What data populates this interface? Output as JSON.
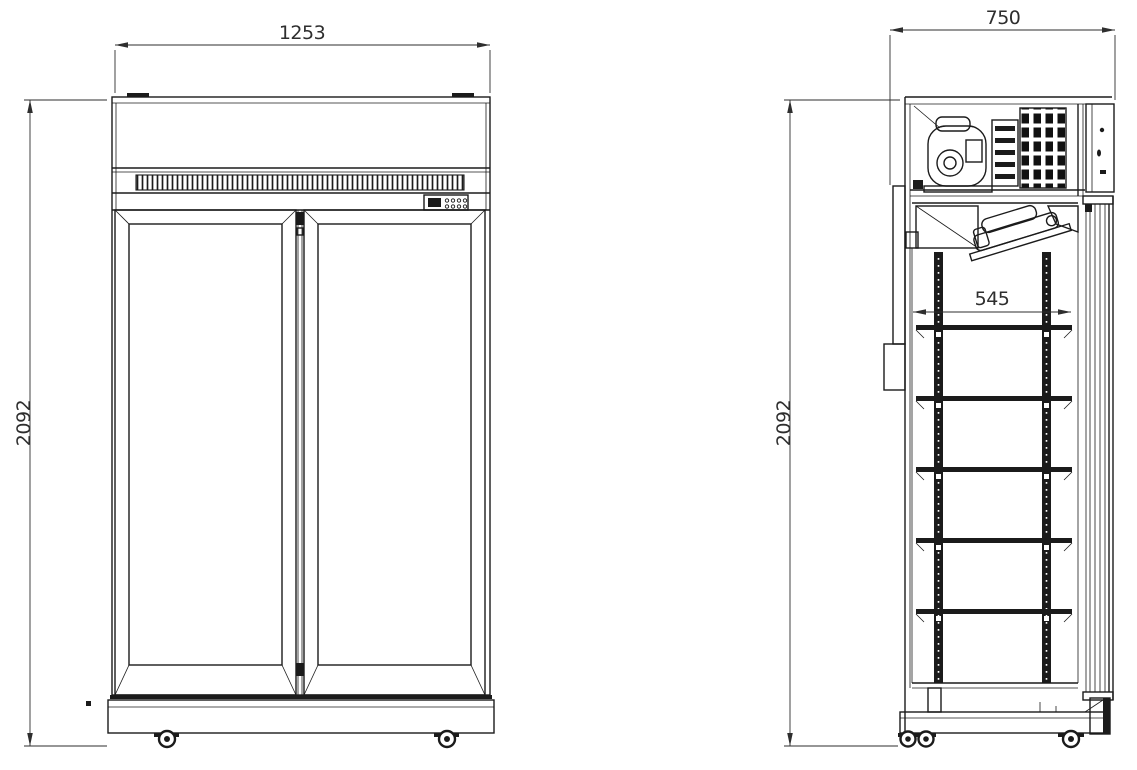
{
  "colors": {
    "line": "#1b1b1b",
    "dim": "#2e2e2e"
  },
  "drawing": {
    "front_view": {
      "width": "1253",
      "height": "2092"
    },
    "side_view": {
      "depth": "750",
      "height": "2092",
      "shelf_depth": "545"
    }
  }
}
